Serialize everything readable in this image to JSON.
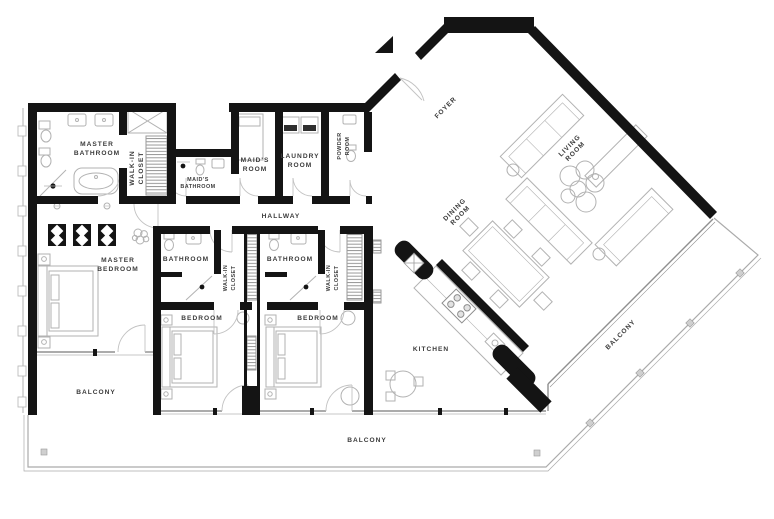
{
  "title": "Apartment Floor Plan",
  "colors": {
    "background": "#ffffff",
    "wall": "#141414",
    "furniture": "#b2b2b2",
    "fixture": "#a8a8a8",
    "door": "#c2c2c2",
    "window": "#8f8f8f",
    "railing": "#ababab",
    "appliance": "#2e2e2e",
    "label": "#3b3b3b"
  },
  "rooms": [
    {
      "id": "master-bathroom",
      "lines": [
        "MASTER",
        "BATHROOM"
      ]
    },
    {
      "id": "master-walk-in-closet",
      "lines": [
        "WALK-IN",
        "CLOSET"
      ]
    },
    {
      "id": "maids-bathroom",
      "lines": [
        "MAID'S",
        "BATHROOM"
      ]
    },
    {
      "id": "maids-room",
      "lines": [
        "MAID'S",
        "ROOM"
      ]
    },
    {
      "id": "laundry-room",
      "lines": [
        "LAUNDRY",
        "ROOM"
      ]
    },
    {
      "id": "powder-room",
      "lines": [
        "POWDER",
        "ROOM"
      ]
    },
    {
      "id": "hallway",
      "lines": [
        "HALLWAY"
      ]
    },
    {
      "id": "foyer",
      "lines": [
        "FOYER"
      ]
    },
    {
      "id": "living-room",
      "lines": [
        "LIVING",
        "ROOM"
      ]
    },
    {
      "id": "dining-room",
      "lines": [
        "DINING",
        "ROOM"
      ]
    },
    {
      "id": "master-bedroom",
      "lines": [
        "MASTER",
        "BEDROOM"
      ]
    },
    {
      "id": "bathroom-1",
      "lines": [
        "BATHROOM"
      ]
    },
    {
      "id": "walk-in-closet-1",
      "lines": [
        "WALK-IN",
        "CLOSET"
      ]
    },
    {
      "id": "bathroom-2",
      "lines": [
        "BATHROOM"
      ]
    },
    {
      "id": "walk-in-closet-2",
      "lines": [
        "WALK-IN",
        "CLOSET"
      ]
    },
    {
      "id": "bedroom-1",
      "lines": [
        "BEDROOM"
      ]
    },
    {
      "id": "bedroom-2",
      "lines": [
        "BEDROOM"
      ]
    },
    {
      "id": "kitchen",
      "lines": [
        "KITCHEN"
      ]
    },
    {
      "id": "balcony-left",
      "lines": [
        "BALCONY"
      ]
    },
    {
      "id": "balcony-bottom",
      "lines": [
        "BALCONY"
      ]
    },
    {
      "id": "balcony-right",
      "lines": [
        "BALCONY"
      ]
    }
  ]
}
